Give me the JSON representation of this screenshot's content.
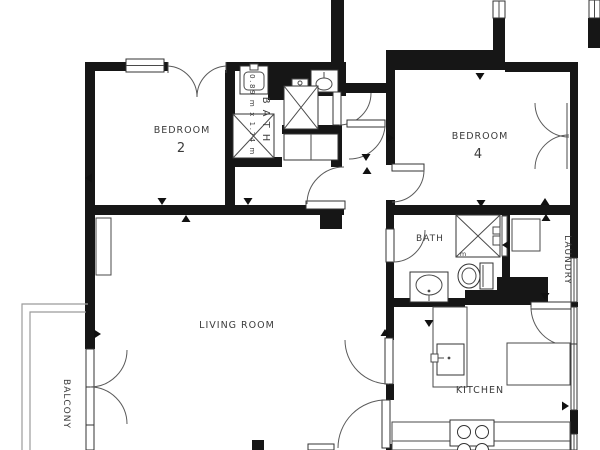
{
  "plan": {
    "rooms": {
      "bedroom2": {
        "title": "BEDROOM",
        "number": "2"
      },
      "bedroom4": {
        "title": "BEDROOM",
        "number": "4"
      },
      "bath1": {
        "title": "BATH",
        "dims": "0.89 m x 1.74 m"
      },
      "bath2": {
        "title": "BATH",
        "shower_mark": "m"
      },
      "living": {
        "title": "LIVING ROOM"
      },
      "balcony": {
        "title": "BALCONY"
      },
      "kitchen": {
        "title": "KITCHEN"
      },
      "laundry": {
        "title": "LAUNDRY"
      }
    },
    "colors": {
      "wall": "#161616",
      "room_number": "#a0a884",
      "label_text": "#3b3b3b",
      "marker": "#111111"
    },
    "markers": [
      {
        "x": 89,
        "y": 178,
        "dir": "left"
      },
      {
        "x": 162,
        "y": 201,
        "dir": "down"
      },
      {
        "x": 186,
        "y": 219,
        "dir": "up"
      },
      {
        "x": 248,
        "y": 201,
        "dir": "down"
      },
      {
        "x": 97,
        "y": 334,
        "dir": "right"
      },
      {
        "x": 480,
        "y": 76,
        "dir": "down"
      },
      {
        "x": 545,
        "y": 202,
        "dir": "up"
      },
      {
        "x": 481,
        "y": 203,
        "dir": "down"
      },
      {
        "x": 366,
        "y": 157,
        "dir": "down"
      },
      {
        "x": 367,
        "y": 171,
        "dir": "up"
      },
      {
        "x": 390,
        "y": 138,
        "dir": "right"
      },
      {
        "x": 506,
        "y": 245,
        "dir": "left"
      },
      {
        "x": 546,
        "y": 218,
        "dir": "up"
      },
      {
        "x": 545,
        "y": 296,
        "dir": "down"
      },
      {
        "x": 565,
        "y": 406,
        "dir": "right"
      },
      {
        "x": 385,
        "y": 333,
        "dir": "up"
      },
      {
        "x": 429,
        "y": 323,
        "dir": "down"
      }
    ]
  }
}
